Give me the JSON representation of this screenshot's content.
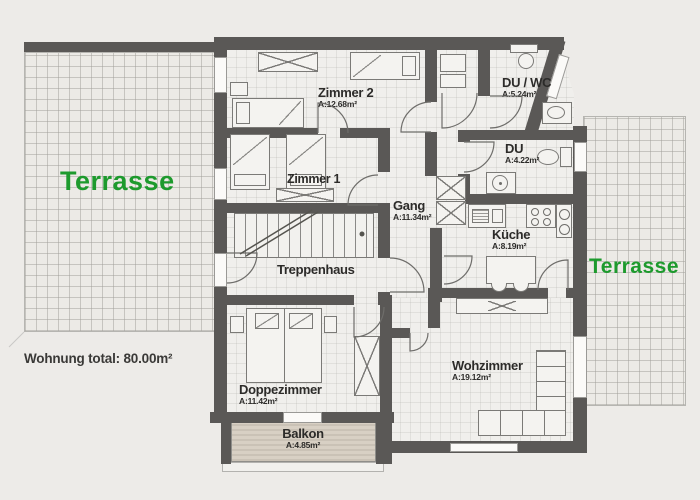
{
  "plan": {
    "terrace_left_label": "Terrasse",
    "terrace_right_label": "Terrasse",
    "total_label": "Wohnung total: 80.00m²",
    "rooms": {
      "zimmer2": {
        "name": "Zimmer 2",
        "area": "A:12.68m²"
      },
      "duwc": {
        "name": "DU / WC",
        "area": "A:5.24m²"
      },
      "du": {
        "name": "DU",
        "area": "A:4.22m²"
      },
      "gang": {
        "name": "Gang",
        "area": "A:11.34m²"
      },
      "kueche": {
        "name": "Küche",
        "area": "A:8.19m²"
      },
      "zimmer1": {
        "name": "Zimmer 1",
        "area": ""
      },
      "treppenhaus": {
        "name": "Treppenhaus",
        "area": ""
      },
      "doppezimmer": {
        "name": "Doppezimmer",
        "area": "A:11.42m²"
      },
      "wohzimmer": {
        "name": "Wohzimmer",
        "area": "A:19.12m²"
      },
      "balkon": {
        "name": "Balkon",
        "area": "A:4.85m²"
      }
    },
    "colors": {
      "wall": "#5a5856",
      "terrace_label_green": "#1d9a2d",
      "balcony_fill": "#d8d0c4"
    }
  }
}
